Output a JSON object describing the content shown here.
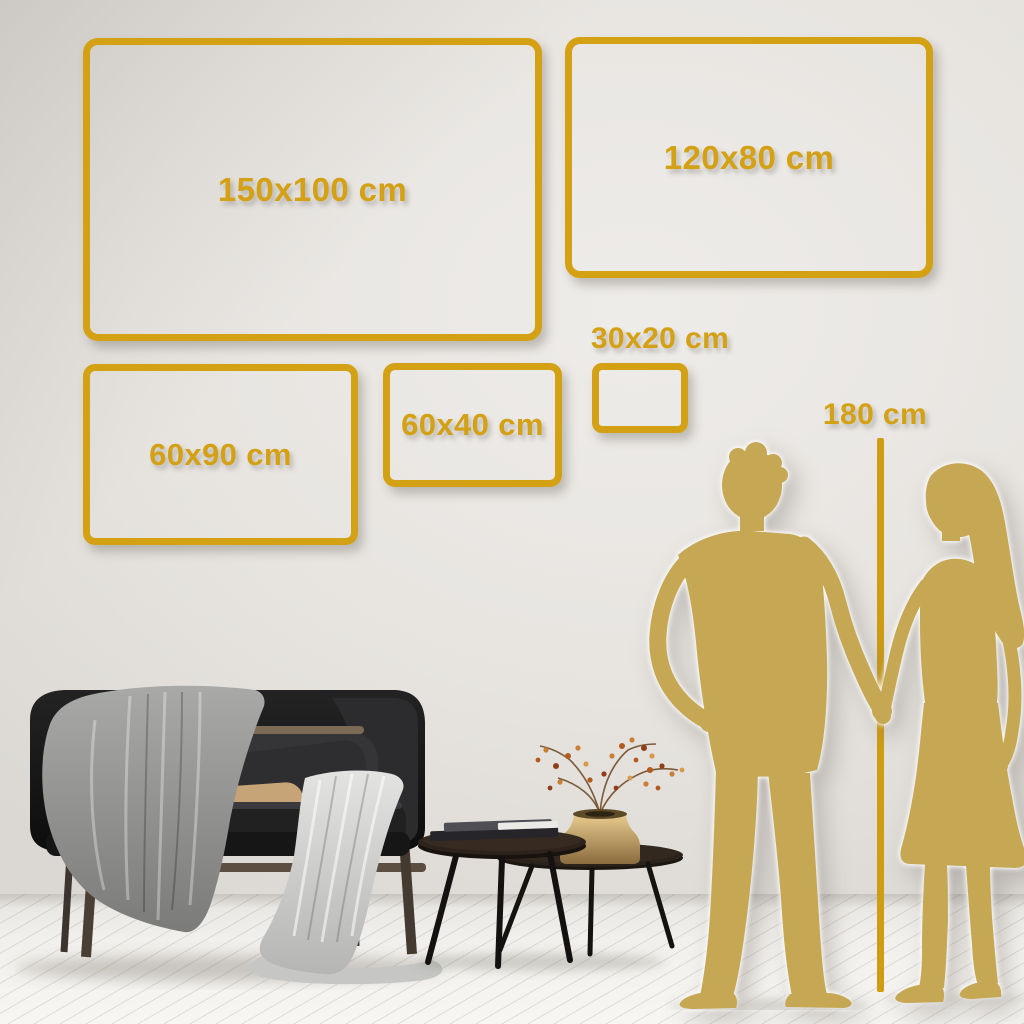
{
  "scene": {
    "type": "wall-art-size-guide",
    "unit": "cm",
    "elements": [
      "sofa",
      "gray-blanket",
      "light-throw",
      "dark-pillow",
      "tan-pillow",
      "nesting-coffee-tables",
      "books",
      "brass-vase-with-dried-branches",
      "man-silhouette",
      "woman-silhouette",
      "height-ruler-line",
      "wood-plank-floor"
    ]
  },
  "frames": [
    {
      "label": "150x100 cm",
      "width_cm": 150,
      "height_cm": 100
    },
    {
      "label": "120x80 cm",
      "width_cm": 120,
      "height_cm": 80
    },
    {
      "label": "60x90 cm",
      "width_cm": 60,
      "height_cm": 90
    },
    {
      "label": "60x40 cm",
      "width_cm": 60,
      "height_cm": 40
    },
    {
      "label": "30x20 cm",
      "width_cm": 30,
      "height_cm": 20
    }
  ],
  "height_reference": {
    "label": "180 cm",
    "height_cm": 180
  },
  "colors": {
    "accent_gold": "#d4a014",
    "silhouette_gold": "#c6a854",
    "wall": "#e7e4e0",
    "floor": "#f2f0ed"
  }
}
